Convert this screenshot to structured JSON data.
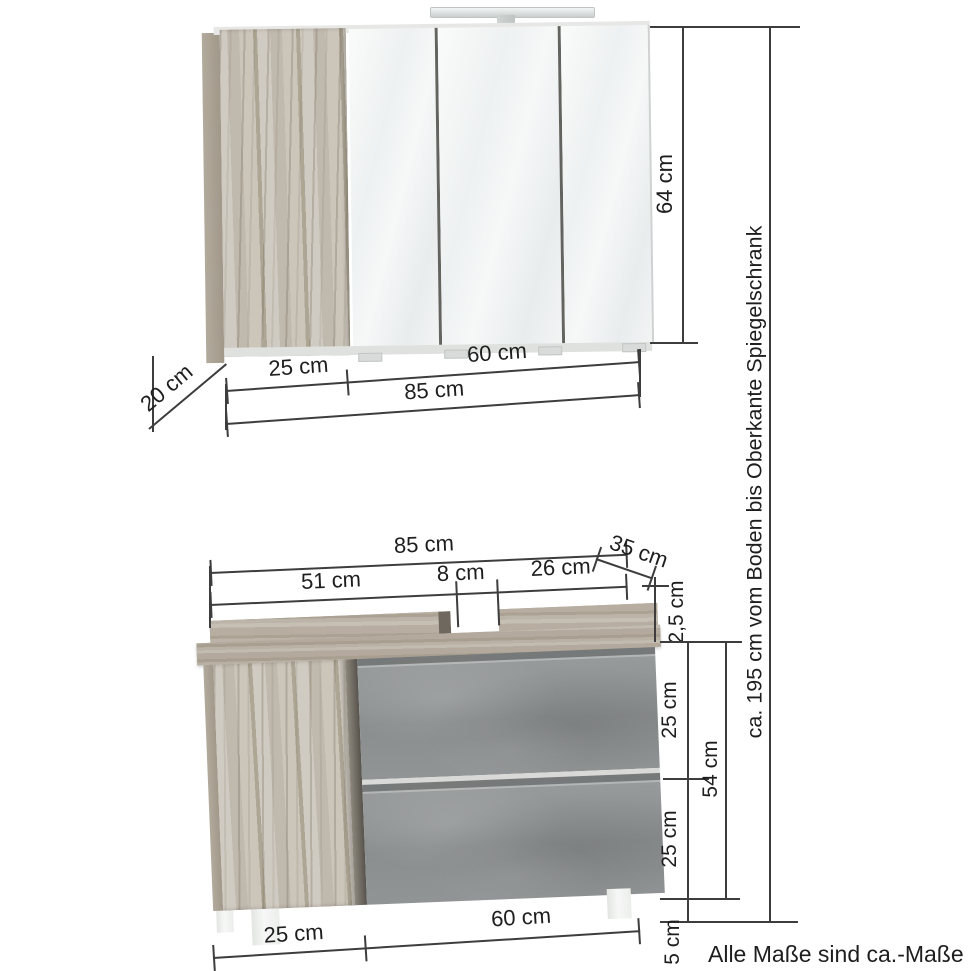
{
  "note": "Alle Maße sind ca.-Maße",
  "dims": {
    "overall_height": "ca. 195 cm vom Boden bis Oberkante Spiegelschrank",
    "mirror_cabinet": {
      "height": "64 cm",
      "depth": "20 cm",
      "door_width": "25 cm",
      "mirror_width": "60 cm",
      "total_width": "85 cm"
    },
    "vanity": {
      "total_width": "85 cm",
      "left_section": "51 cm",
      "cutout": "8 cm",
      "right_section": "26 cm",
      "depth": "35 cm",
      "top_thickness": "2,5 cm",
      "upper_drawer": "25 cm",
      "body_height": "54 cm",
      "lower_drawer": "25 cm",
      "feet_height": "5 cm",
      "base_door_width": "25 cm",
      "base_drawer_width": "60 cm"
    }
  },
  "colors": {
    "dimension_line": "#3d3d3d",
    "wood": "#c8c2b7",
    "wood_dark": "#a89f90",
    "concrete": "#8e9192",
    "mirror": "#eef1f1"
  }
}
